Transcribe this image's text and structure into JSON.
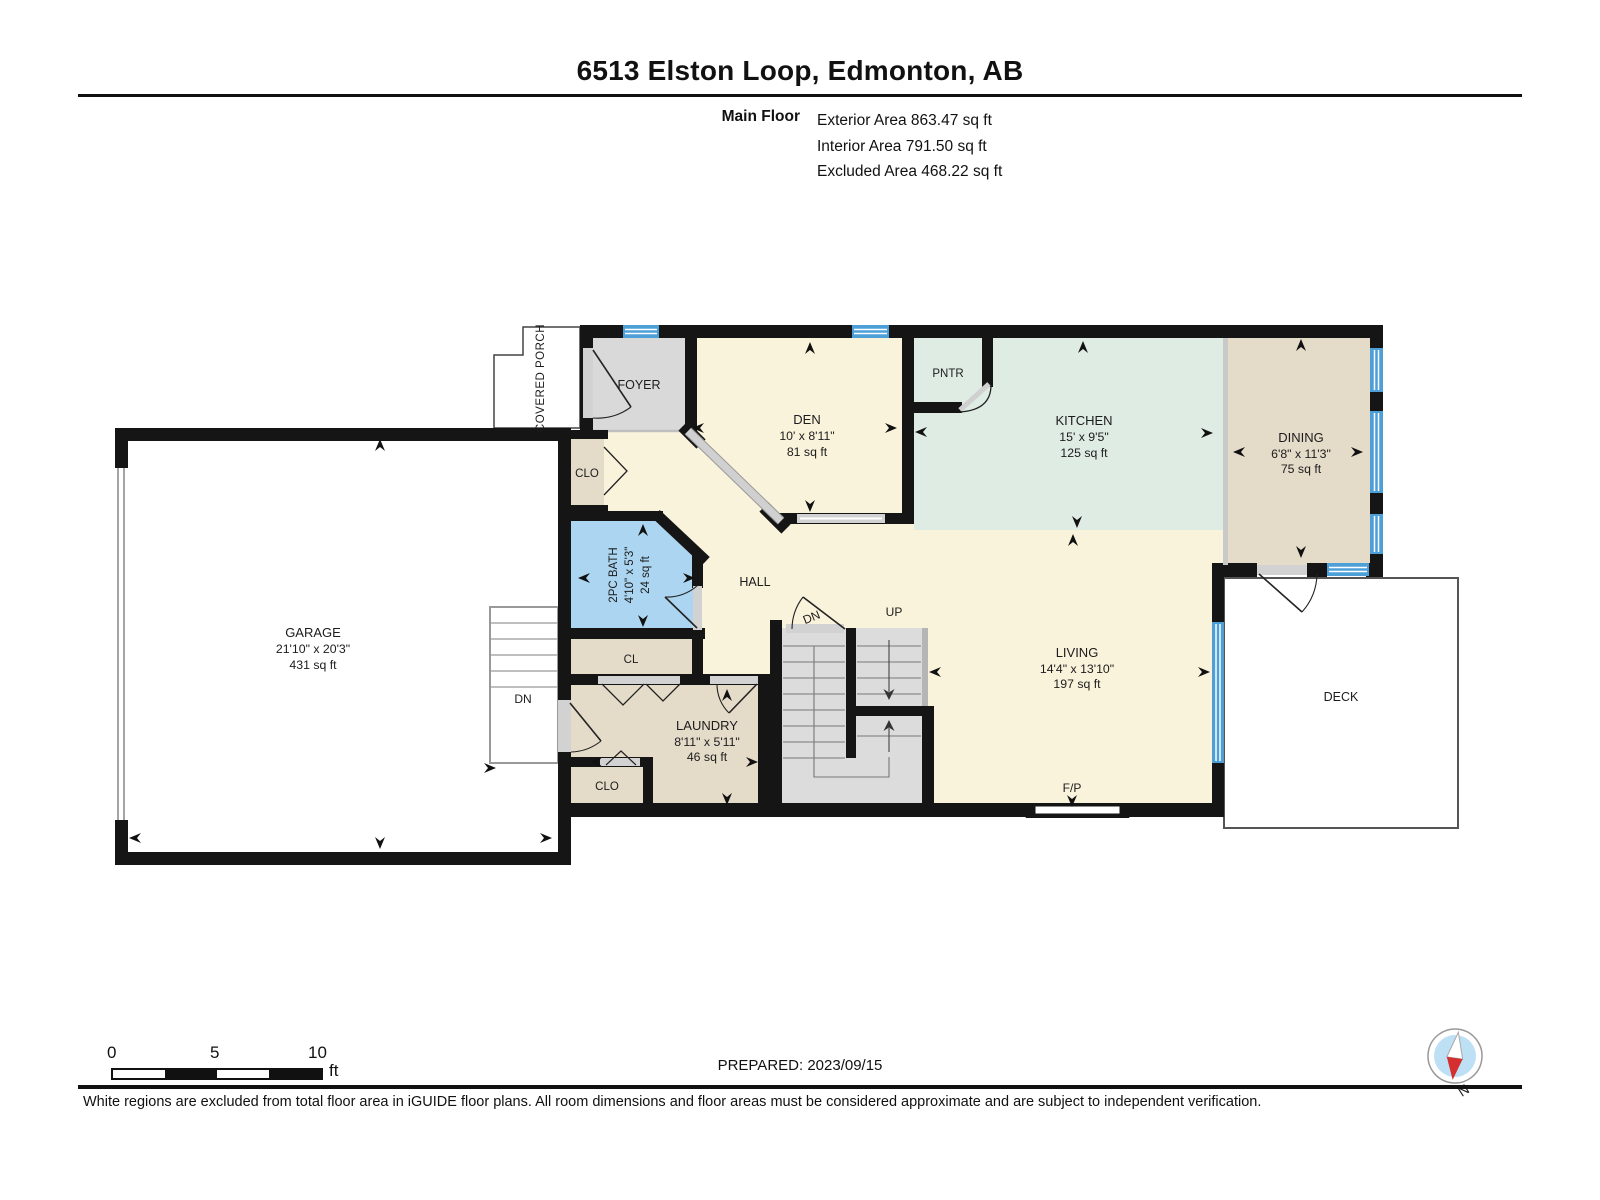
{
  "header": {
    "title": "6513 Elston Loop, Edmonton, AB",
    "floor_label": "Main Floor",
    "stat1": "Exterior Area 863.47 sq ft",
    "stat2": "Interior Area 791.50 sq ft",
    "stat3": "Excluded Area 468.22 sq ft"
  },
  "plan": {
    "covered_porch": "COVERED PORCH",
    "foyer": "FOYER",
    "clo_foyer": "CLO",
    "den": {
      "name": "DEN",
      "dims": "10' x 8'11\"",
      "area": "81 sq ft"
    },
    "pantry": "PNTR",
    "kitchen": {
      "name": "KITCHEN",
      "dims": "15' x 9'5\"",
      "area": "125 sq ft"
    },
    "dining": {
      "name": "DINING",
      "dims": "6'8\" x 11'3\"",
      "area": "75 sq ft"
    },
    "bath": {
      "name": "2PC BATH",
      "dims": "4'10\" x 5'3\"",
      "area": "24 sq ft"
    },
    "hall": "HALL",
    "cl": "CL",
    "laundry": {
      "name": "LAUNDRY",
      "dims": "8'11\" x 5'11\"",
      "area": "46 sq ft"
    },
    "clo_laundry": "CLO",
    "garage": {
      "name": "GARAGE",
      "dims": "21'10\" x 20'3\"",
      "area": "431 sq ft"
    },
    "living": {
      "name": "LIVING",
      "dims": "14'4\" x 13'10\"",
      "area": "197 sq ft"
    },
    "fireplace": "F/P",
    "deck": "DECK",
    "stair_dn": "DN",
    "stair_up": "UP",
    "stair_dn_ext": "DN"
  },
  "footer": {
    "scale_0": "0",
    "scale_5": "5",
    "scale_10": "10",
    "scale_unit": "ft",
    "prepared": "PREPARED: 2023/09/15",
    "compass_n": "N",
    "disclaimer": "White regions are excluded from total floor area in iGUIDE floor plans. All room dimensions and floor areas must be considered approximate and are subject to independent verification."
  },
  "colors": {
    "wall": "#151515",
    "interior_cream": "#FAF3DC",
    "kitchen_mint": "#DFECE3",
    "tan": "#E5DBC9",
    "bath_blue": "#ABD5F0",
    "room_gray": "#D9D9D9",
    "stair_gray": "#DCDCDC",
    "window_blue": "#4D9FD8",
    "opening_gray": "#D2D2D2",
    "compass_red": "#D42E2E",
    "compass_blue": "#BEE0F4"
  }
}
